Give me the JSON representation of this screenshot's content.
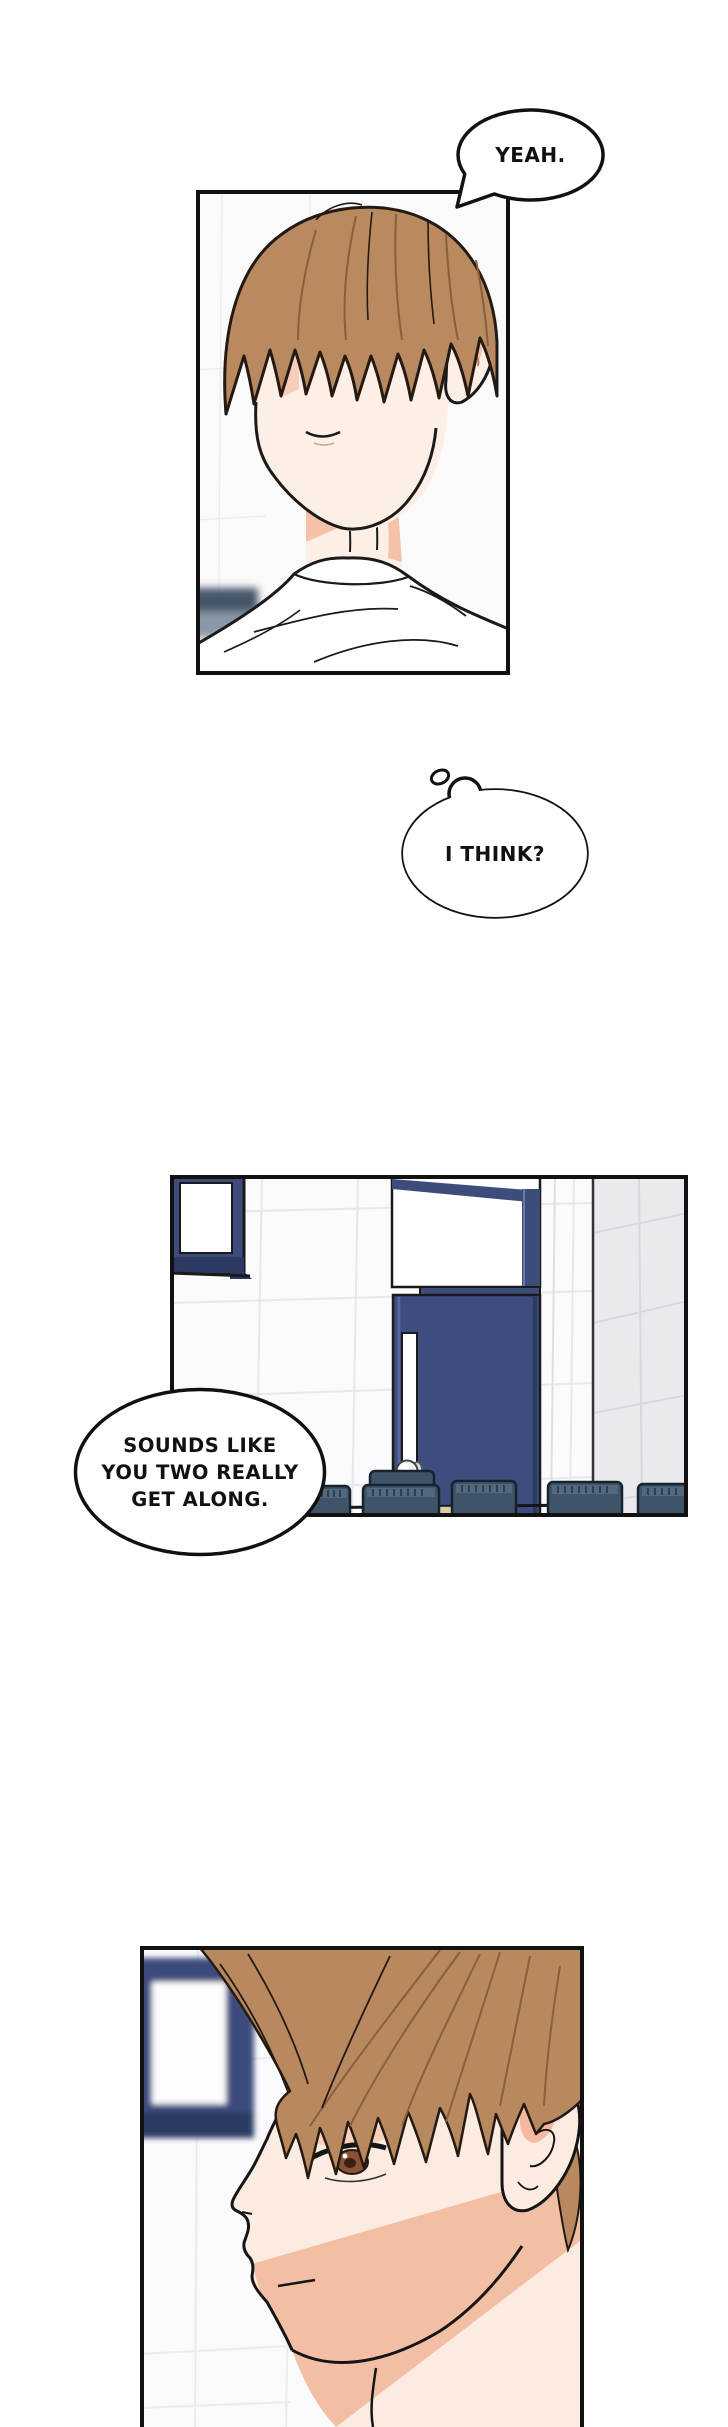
{
  "bubbles": {
    "yeah": {
      "text": "YEAH."
    },
    "think": {
      "text": "I THINK?"
    },
    "get_along": {
      "line1": "SOUNDS LIKE",
      "line2": "YOU TWO REALLY",
      "line3": "GET ALONG."
    }
  },
  "colors": {
    "page_bg": "#ffffff",
    "ink": "#111111",
    "hair_brown": "#b9895f",
    "hair_strand": "#8a5f3e",
    "skin": "#fdeee6",
    "skin_profile": "#fcebe0",
    "skin_shadow": "#f5c2a9",
    "iris_brown": "#7c4a31",
    "navy_frame": "#3e4c7c",
    "navy_dark": "#2c3a63",
    "chair_slate": "#3d5469",
    "chair_top": "#52687e",
    "desk_tan": "#d9caa0",
    "wall_white": "#fbfbfd",
    "wall_gray": "#eaeaee",
    "tile_line": "#e8e8ec"
  }
}
